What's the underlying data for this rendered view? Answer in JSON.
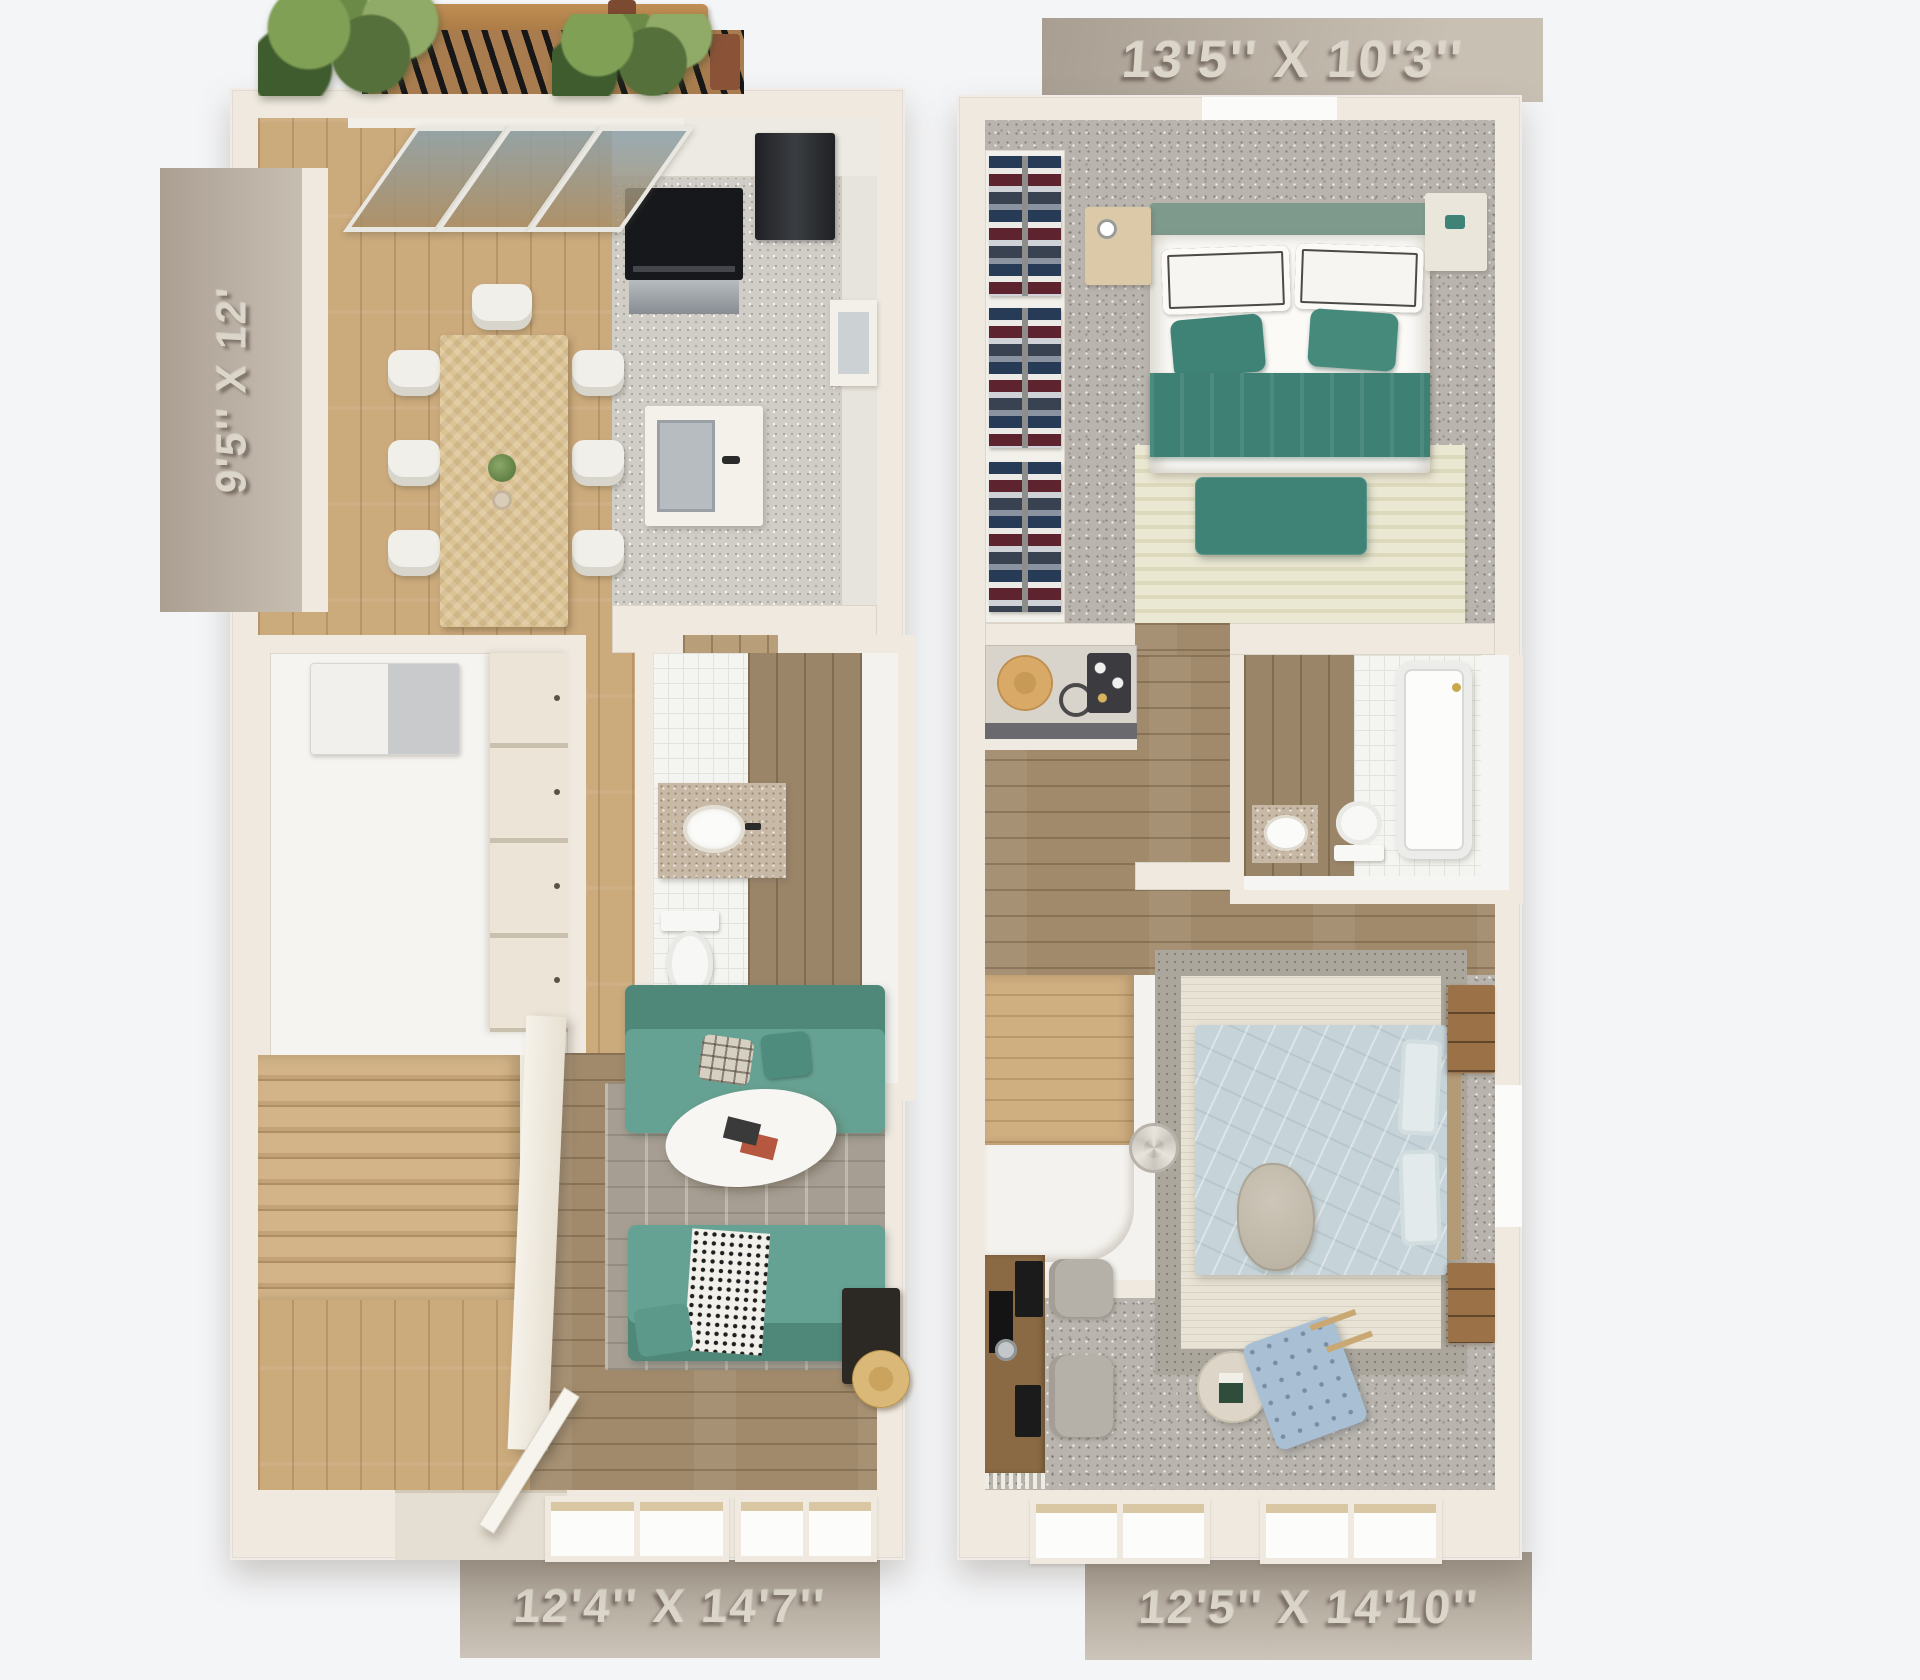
{
  "dimension_labels": {
    "right_unit_top": "13'5'' X 10'3''",
    "left_unit_side": "9'5'' X 12'",
    "left_unit_bottom": "12'4'' X 14'7''",
    "right_unit_bottom": "12'5'' X 14'10''"
  },
  "colors": {
    "background": "#f4f5f7",
    "wall": "#efe9e0",
    "tab_background": "#b4aa9e",
    "tab_text": "#dcd6ca",
    "wood_light": "#cbaa7c",
    "wood_dark": "#a18a6b",
    "carpet_gray": "#b9b5ae",
    "sofa_teal": "#66a293",
    "bed_teal": "#3e8174",
    "bed_blue": "#c6d4d9",
    "stair_wood": "#cfae80",
    "rug_gray": "#a69e92",
    "rug_cream": "#e8e3d5",
    "deck_wood": "#a87c4e",
    "plant_green": "#55703a",
    "appliance_black": "#17181b"
  }
}
